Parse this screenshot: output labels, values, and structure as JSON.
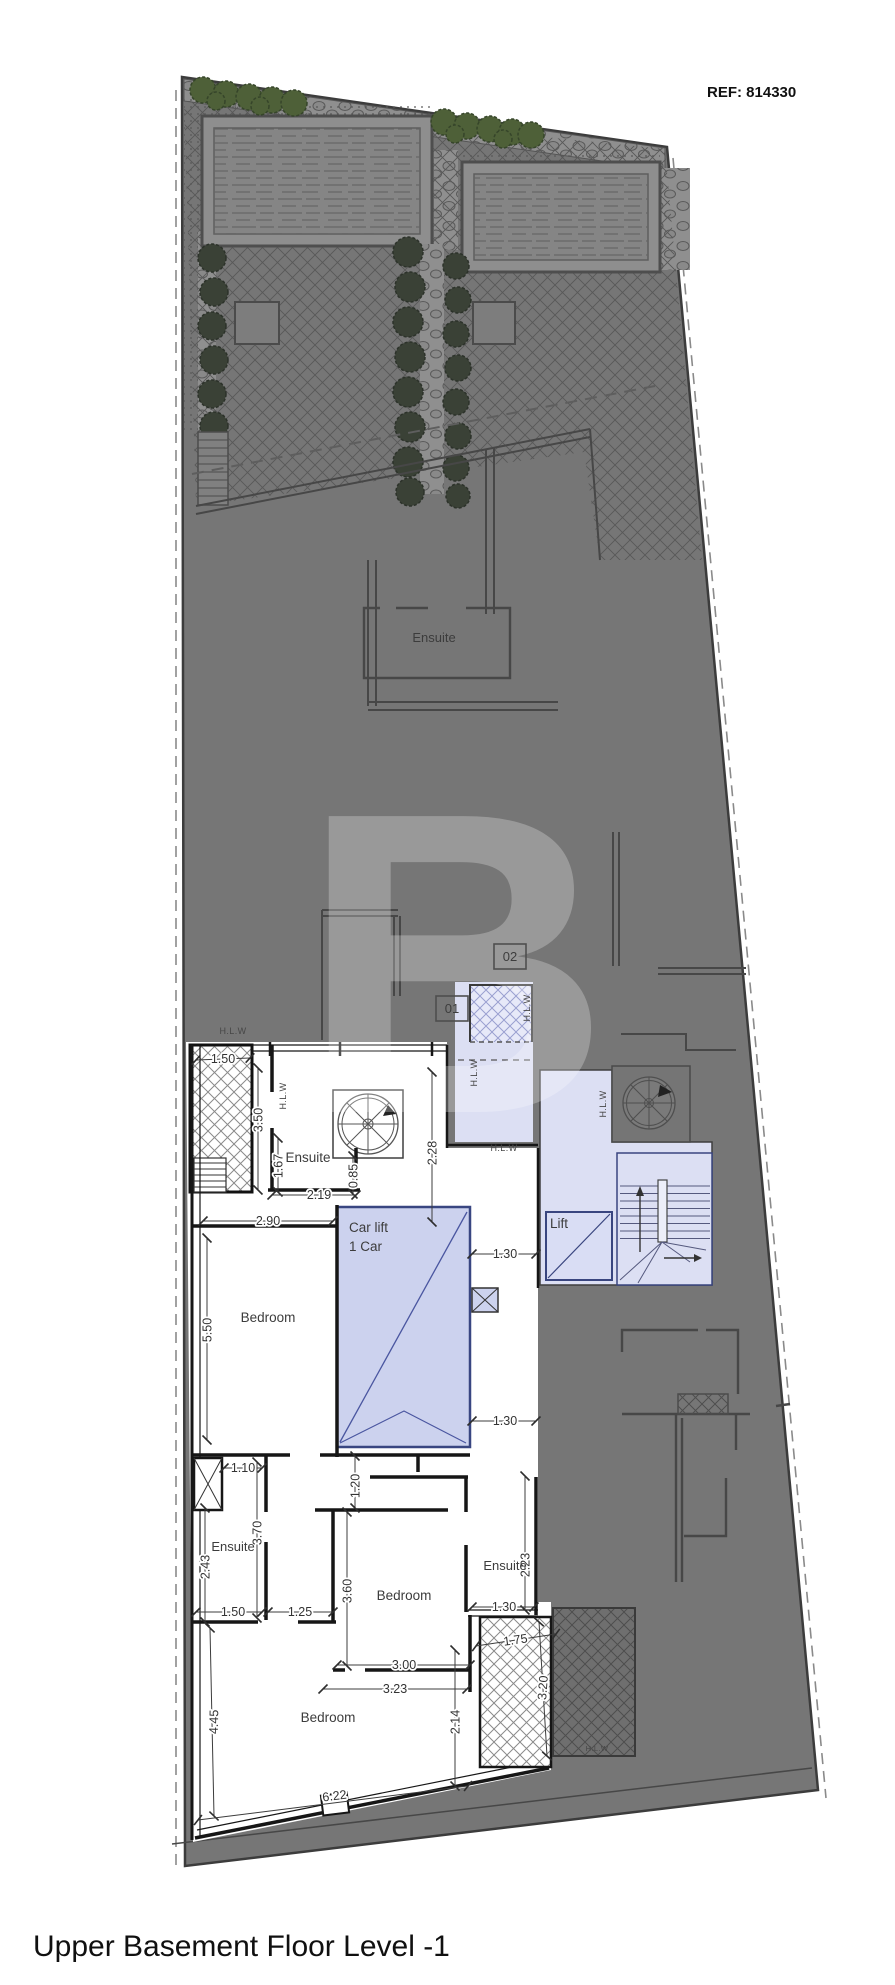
{
  "meta": {
    "ref_label": "REF: 814330",
    "plan_title": "Upper Basement Floor Level -1",
    "watermark_letter": "B"
  },
  "colors": {
    "site_gray": "#767676",
    "site_outline": "#3c3c3c",
    "lavender": "#dcdff3",
    "car_lift_fill": "#ccd2ee",
    "car_lift_border": "#394681",
    "wall_black": "#161616",
    "garden_green": "#4e6038",
    "shrub_dark": "#3a4136"
  },
  "room_labels": [
    {
      "id": "ensuite-top",
      "text": "Ensuite",
      "x": 434,
      "y": 642,
      "size": 13,
      "anchor": "middle"
    },
    {
      "id": "ensuite-a",
      "text": "Ensuite",
      "x": 308,
      "y": 1162,
      "size": 13.5,
      "anchor": "middle"
    },
    {
      "id": "bedroom-left",
      "text": "Bedroom",
      "x": 268,
      "y": 1322,
      "size": 13.5,
      "anchor": "middle"
    },
    {
      "id": "car-lift-line1",
      "text": "Car lift",
      "x": 349,
      "y": 1232,
      "size": 13.5,
      "anchor": "start"
    },
    {
      "id": "car-lift-line2",
      "text": "1 Car",
      "x": 349,
      "y": 1251,
      "size": 13.5,
      "anchor": "start"
    },
    {
      "id": "lift",
      "text": "Lift",
      "x": 550,
      "y": 1228,
      "size": 13.5,
      "anchor": "start"
    },
    {
      "id": "ensuite-b",
      "text": "Ensuite",
      "x": 233,
      "y": 1551,
      "size": 13,
      "anchor": "middle"
    },
    {
      "id": "bedroom-mid",
      "text": "Bedroom",
      "x": 404,
      "y": 1600,
      "size": 13.5,
      "anchor": "middle"
    },
    {
      "id": "ensuite-c",
      "text": "Ensuite",
      "x": 505,
      "y": 1570,
      "size": 13,
      "anchor": "middle"
    },
    {
      "id": "bedroom-bottom",
      "text": "Bedroom",
      "x": 328,
      "y": 1722,
      "size": 13.5,
      "anchor": "middle"
    }
  ],
  "hlw_labels": [
    {
      "text": "H.L.W",
      "x": 233,
      "y": 1034,
      "rot": 0,
      "size": 9
    },
    {
      "text": "H.L.W",
      "x": 286,
      "y": 1096,
      "rot": -90,
      "size": 9
    },
    {
      "text": "H.L.W",
      "x": 530,
      "y": 1008,
      "rot": -90,
      "size": 9
    },
    {
      "text": "H.L.W",
      "x": 477,
      "y": 1073,
      "rot": -90,
      "size": 9
    },
    {
      "text": "H.L.W",
      "x": 504,
      "y": 1151,
      "rot": 0,
      "size": 9
    },
    {
      "text": "H.L.W",
      "x": 606,
      "y": 1104,
      "rot": -90,
      "size": 9
    },
    {
      "text": "H.L.W",
      "x": 597,
      "y": 1751,
      "rot": 0,
      "size": 7.5
    }
  ],
  "unit_markers": [
    {
      "text": "01",
      "x": 452,
      "y": 1009
    },
    {
      "text": "02",
      "x": 510,
      "y": 957
    }
  ],
  "dimensions": [
    {
      "text": "1.50",
      "x1": 196,
      "y1": 1060,
      "x2": 250,
      "y2": 1058,
      "tx": 223,
      "ty": 1063,
      "rot": 0
    },
    {
      "text": "3.50",
      "x1": 258,
      "y1": 1068,
      "x2": 258,
      "y2": 1190,
      "tx": 262.5,
      "ty": 1120,
      "rot": -90
    },
    {
      "text": "1.67",
      "x1": 278,
      "y1": 1138,
      "x2": 278,
      "y2": 1192,
      "tx": 282.5,
      "ty": 1166,
      "rot": -90
    },
    {
      "text": "0.85",
      "x1": 353,
      "y1": 1156,
      "x2": 353,
      "y2": 1194,
      "tx": 357.5,
      "ty": 1176,
      "rot": -90
    },
    {
      "text": "2.19",
      "x1": 272,
      "y1": 1195,
      "x2": 356,
      "y2": 1195,
      "tx": 319,
      "ty": 1199,
      "rot": 0
    },
    {
      "text": "2.28",
      "x1": 432,
      "y1": 1072,
      "x2": 432,
      "y2": 1222,
      "tx": 436.5,
      "ty": 1153,
      "rot": -90
    },
    {
      "text": "2.90",
      "x1": 203,
      "y1": 1221,
      "x2": 333,
      "y2": 1221,
      "tx": 268,
      "ty": 1225,
      "rot": 0
    },
    {
      "text": "5.50",
      "x1": 207,
      "y1": 1238,
      "x2": 207,
      "y2": 1440,
      "tx": 211.5,
      "ty": 1330,
      "rot": -90
    },
    {
      "text": "1.30",
      "x1": 472,
      "y1": 1254,
      "x2": 536,
      "y2": 1254,
      "tx": 505,
      "ty": 1258,
      "rot": 0
    },
    {
      "text": "1.30",
      "x1": 472,
      "y1": 1421,
      "x2": 536,
      "y2": 1421,
      "tx": 505,
      "ty": 1425,
      "rot": 0
    },
    {
      "text": "1.10",
      "x1": 224,
      "y1": 1468,
      "x2": 262,
      "y2": 1468,
      "tx": 243,
      "ty": 1472,
      "rot": 0
    },
    {
      "text": "3.70",
      "x1": 257,
      "y1": 1462,
      "x2": 257,
      "y2": 1618,
      "tx": 261.5,
      "ty": 1533,
      "rot": -90
    },
    {
      "text": "2.43",
      "x1": 205,
      "y1": 1508,
      "x2": 205,
      "y2": 1622,
      "tx": 209.5,
      "ty": 1567,
      "rot": -90
    },
    {
      "text": "1.20",
      "x1": 355,
      "y1": 1456,
      "x2": 355,
      "y2": 1508,
      "tx": 359.5,
      "ty": 1486,
      "rot": -90
    },
    {
      "text": "1.50",
      "x1": 196,
      "y1": 1612,
      "x2": 262,
      "y2": 1612,
      "tx": 233,
      "ty": 1616,
      "rot": 0
    },
    {
      "text": "1.25",
      "x1": 268,
      "y1": 1612,
      "x2": 333,
      "y2": 1612,
      "tx": 300,
      "ty": 1616,
      "rot": 0
    },
    {
      "text": "3.60",
      "x1": 347,
      "y1": 1512,
      "x2": 347,
      "y2": 1666,
      "tx": 351.5,
      "ty": 1591,
      "rot": -90
    },
    {
      "text": "2.23",
      "x1": 525,
      "y1": 1476,
      "x2": 525,
      "y2": 1610,
      "tx": 529.5,
      "ty": 1565,
      "rot": -90
    },
    {
      "text": "1.30",
      "x1": 472,
      "y1": 1607,
      "x2": 534,
      "y2": 1607,
      "tx": 504,
      "ty": 1611,
      "rot": 0
    },
    {
      "text": "1.75",
      "x1": 476,
      "y1": 1646,
      "x2": 556,
      "y2": 1634,
      "tx": 516,
      "ty": 1644,
      "rot": -8
    },
    {
      "text": "3.20",
      "x1": 539,
      "y1": 1622,
      "x2": 547,
      "y2": 1756,
      "tx": 547,
      "ty": 1688,
      "rot": -86
    },
    {
      "text": "3.00",
      "x1": 337,
      "y1": 1665,
      "x2": 470,
      "y2": 1665,
      "tx": 404,
      "ty": 1669,
      "rot": 0
    },
    {
      "text": "3.23",
      "x1": 323,
      "y1": 1689,
      "x2": 467,
      "y2": 1689,
      "tx": 395,
      "ty": 1693,
      "rot": 0
    },
    {
      "text": "4.45",
      "x1": 210,
      "y1": 1628,
      "x2": 214,
      "y2": 1816,
      "tx": 218,
      "ty": 1722,
      "rot": -89
    },
    {
      "text": "2.14",
      "x1": 455,
      "y1": 1650,
      "x2": 455,
      "y2": 1786,
      "tx": 459.5,
      "ty": 1722,
      "rot": -90
    },
    {
      "text": "6.22",
      "x1": 198,
      "y1": 1820,
      "x2": 468,
      "y2": 1786,
      "tx": 335,
      "ty": 1800,
      "rot": -7
    }
  ]
}
